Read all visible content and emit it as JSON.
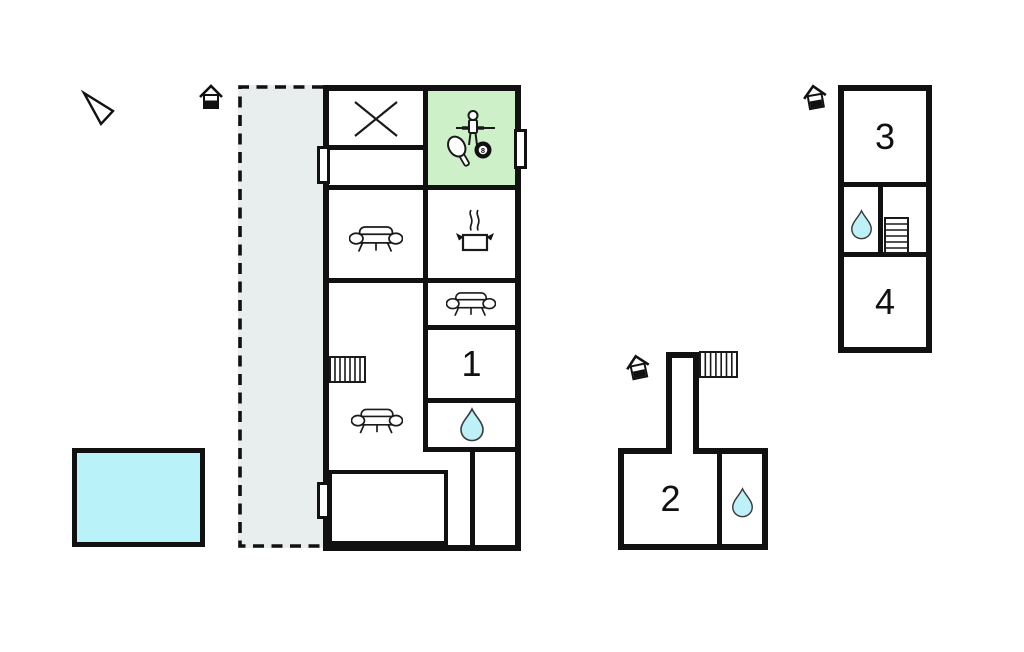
{
  "plan": {
    "room_labels": {
      "r1": "1",
      "r2": "2",
      "r3": "3",
      "r4": "4"
    },
    "billiard_ball_number": "8",
    "colors": {
      "wall": "#111111",
      "game_room_fill": "#cdf0c8",
      "terrace_fill": "#e8eeee",
      "pool_fill": "#b9f3f9",
      "water_drop_fill": "#bef0f8"
    },
    "icons": {
      "north_arrow": "north-arrow-icon",
      "entrance": "entrance-icon",
      "cross": "cross-icon",
      "foosball_player": "foosball-player-icon",
      "table_tennis_paddle": "table-tennis-paddle-icon",
      "billiard_ball": "billiard-ball-icon",
      "sofa": "sofa-icon",
      "cooking_pot": "cooking-pot-icon",
      "stairs": "stairs-icon",
      "water_drop": "water-drop-icon"
    }
  }
}
